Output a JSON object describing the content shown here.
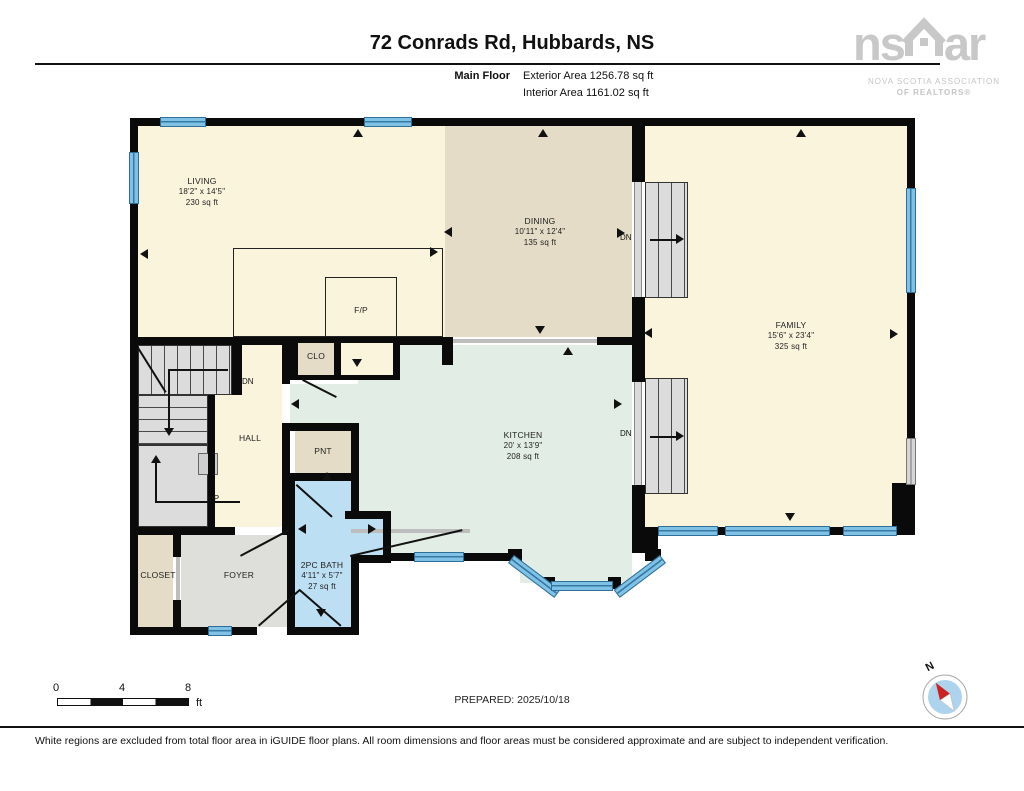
{
  "header": {
    "title": "72 Conrads Rd, Hubbards, NS",
    "floor_label": "Main Floor",
    "exterior_area": "Exterior Area 1256.78 sq ft",
    "interior_area": "Interior Area 1161.02 sq ft"
  },
  "logo": {
    "prefix": "ns",
    "suffix": "ar",
    "tagline1": "NOVA SCOTIA ASSOCIATION",
    "tagline2": "OF REALTORS®",
    "color": "#C8C8C8"
  },
  "rooms": {
    "living": {
      "name": "LIVING",
      "dim": "18'2\" x 14'5\"",
      "area": "230 sq ft"
    },
    "dining": {
      "name": "DINING",
      "dim": "10'11\" x 12'4\"",
      "area": "135 sq ft"
    },
    "family": {
      "name": "FAMILY",
      "dim": "15'6\" x 23'4\"",
      "area": "325 sq ft"
    },
    "kitchen": {
      "name": "KITCHEN",
      "dim": "20' x 13'9\"",
      "area": "208 sq ft"
    },
    "bath": {
      "name": "2PC BATH",
      "dim": "4'11\" x 5'7\"",
      "area": "27 sq ft"
    },
    "hall": {
      "name": "HALL"
    },
    "foyer": {
      "name": "FOYER"
    },
    "closet": {
      "name": "CLOSET"
    },
    "pantry": {
      "name": "PNT"
    },
    "clo": {
      "name": "CLO"
    },
    "fireplace": {
      "name": "F/P"
    }
  },
  "stairs": {
    "down": "DN",
    "up": "UP"
  },
  "scale_bar": {
    "ticks": [
      "0",
      "4",
      "8"
    ],
    "unit": "ft"
  },
  "prepared": "PREPARED: 2025/10/18",
  "compass": {
    "north": "N"
  },
  "footer": "White regions are excluded from total floor area in iGUIDE floor plans. All room dimensions and floor areas must be considered approximate and are subject to independent verification.",
  "colors": {
    "wall": "#0A0A0A",
    "room_cream": "#FBF4DD",
    "room_tan": "#E4DCC7",
    "room_mint": "#E2EDE5",
    "room_bathblue": "#BDDFF4",
    "room_gray": "#DEDEDB",
    "window_blue": "#7FC2E5",
    "compass_red": "#CC2222"
  }
}
